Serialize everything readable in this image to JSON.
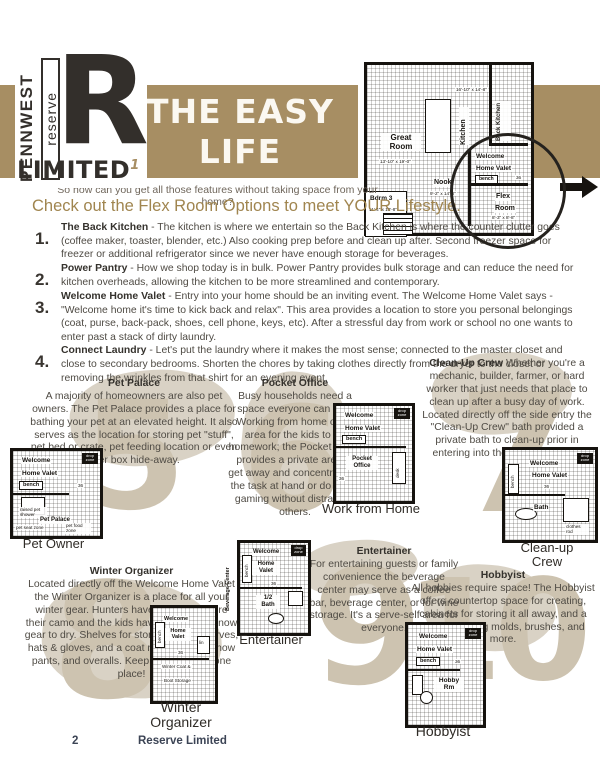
{
  "logo": {
    "pennwest": "PENNWEST",
    "reserve": "reserve",
    "big_letter": "R",
    "limited": "LIMITED",
    "superscript": "1"
  },
  "banner": {
    "line1": "THE EASY",
    "line2": "LIFE"
  },
  "intro": {
    "question": "So how can you get all those features without taking space from your home?",
    "heading": "Check out the Flex Room Options to meet YOUR Lifestyle."
  },
  "list": [
    {
      "num": "1.",
      "lead": "The Back Kitchen",
      "text": " - The kitchen is where we entertain so the Back Kitchen is where the counter clutter goes (coffee maker, toaster, blender, etc.) Also cooking prep before and clean up after. Second freezer space for freezer or additional refrigerator since we never have enough storage for beverages."
    },
    {
      "num": "2.",
      "lead": "Power Pantry",
      "text": " - How we shop today is in bulk. Power Pantry provides bulk storage and can reduce the need for kitchen overheads, allowing the kitchen to be more streamlined and contemporary."
    },
    {
      "num": "3.",
      "lead": "Welcome Home Valet",
      "text": " - Entry into your home should be an inviting event. The Welcome Home Valet says - \"Welcome home it's time to kick back and relax\". This area provides a location to store you personal belongings (coat, purse, back-pack, shoes, cell phone, keys, etc). After a stressful day from work or school no one wants to enter past a stack of dirty laundry."
    },
    {
      "num": "4.",
      "lead": "Connect Laundry",
      "text": " - Let's put the laundry where it makes the most sense; connected to the master closet and close to secondary bedrooms. Shorten the chores by taking clothes directly from the dryer to the closet or removing the wrinkles from that shirt for an evening event."
    }
  ],
  "main_plan": {
    "great_room": "Great Room",
    "great_room_dims": "13'-10\" x 19'-0\"",
    "kitchen": "Kitchen",
    "kitchen_dims": "16'-10\" x 14'-8\"",
    "back_kitchen": "Back Kitchen",
    "welcome": "Welcome",
    "home_valet": "Home Valet",
    "bench": "bench",
    "valet_size": "36",
    "nook": "Nook",
    "nook_dims": "9'-2\" x 14'-8\"",
    "flex": "Flex",
    "room": "Room",
    "flex_dims": "8'-3\" x 8'-8\"",
    "bdrm3": "Bdrm 3",
    "bdrm3_dims": "11'-4\" x 10'-8\""
  },
  "options": [
    {
      "watermark": "5",
      "title": "Pet Palace",
      "text": "A majority of homeowners are also pet owners. The Pet Palace provides a place for bathing your pet at an elevated height. It also serves as the location for storing pet \"stuff\", pet bed or crate, pet feeding location or even litter box hide-away.",
      "plan": {
        "caption": "Pet Owner",
        "welcome": "Welcome",
        "home_valet": "Home Valet",
        "bench": "bench",
        "drop_zone": "drop zone",
        "size": "36",
        "feature1": "raised pet shower",
        "feature2": "Pet Palace",
        "feature3": "pet food zone",
        "feature4": "pet seat zone"
      }
    },
    {
      "watermark": "6",
      "title": "Pocket Office",
      "text": "Busy households need a space everyone can use. Working from home or an area for the kids to do homework; the Pocket Office provides a private area to get away and concentrate on the task at hand or do some gaming without distracting others.",
      "plan": {
        "caption": "Work from Home",
        "welcome": "Welcome",
        "home_valet": "Home Valet",
        "bench": "bench",
        "drop_zone": "drop zone",
        "size": "36",
        "feature1": "Pocket Office",
        "feature2": "desk"
      }
    },
    {
      "watermark": "7",
      "title": "Clean-Up Crew",
      "text": "Whether you're a mechanic, builder, farmer, or hard worker that just needs that place to clean up after a busy day of work. Located directly off the side entry the \"Clean-Up Crew\" bath provided a private bath to clean-up prior in entering into the common areas.",
      "plan": {
        "caption_line1": "Clean-up",
        "caption_line2": "Crew",
        "welcome": "Welcome",
        "home_valet": "Home Valet",
        "bench": "bench",
        "drop_zone": "drop zone",
        "size": "36",
        "feature1": "Bath",
        "feature2": "clothes rod"
      }
    },
    {
      "watermark": "8",
      "title": "Winter Organizer",
      "text": "Located directly off the Welcome Home Valet the Winter Organizer is a place for all your winter gear. Hunters have a place to store their camo and the kids have a place for snow gear to dry. Shelves for storing boots, scarves, hats & gloves, and a coat rod for coats, snow pants, and overalls. Keep everything in one place!",
      "plan": {
        "caption_line1": "Winter",
        "caption_line2": "Organizer",
        "welcome": "Welcome",
        "home_valet": "Home Valet",
        "bench": "bench",
        "size": "36",
        "feature1": "Winter Coat &",
        "feature2": "Boot Storage",
        "feature3": "lin"
      }
    },
    {
      "watermark": "9",
      "title": "Entertainer",
      "text": "For entertaining guests or family convenience the beverage center may serve as a coffee bar, beverage center, or for wine storage. It's a serve-self area for everyone.",
      "plan": {
        "caption": "Entertainer",
        "welcome": "Welcome",
        "home_valet": "Home Valet",
        "bench": "bench",
        "drop_zone": "drop zone",
        "size": "36",
        "feature1": "1/2 Bath",
        "feature2": "Beverage Center"
      }
    },
    {
      "watermark": "10",
      "title": "Hobbyist",
      "text": "All hobbies require space! The Hobbyist offers countertop space for creating, cabinets for storing it all away, and a sink for rinsing molds, brushes, and more.",
      "plan": {
        "caption": "Hobbyist",
        "welcome": "Welcome",
        "home_valet": "Home Valet",
        "bench": "bench",
        "drop_zone": "drop zone",
        "size": "36",
        "feature1": "Hobby Rm"
      }
    }
  ],
  "footer": {
    "page_number": "2",
    "title": "Reserve Limited"
  }
}
